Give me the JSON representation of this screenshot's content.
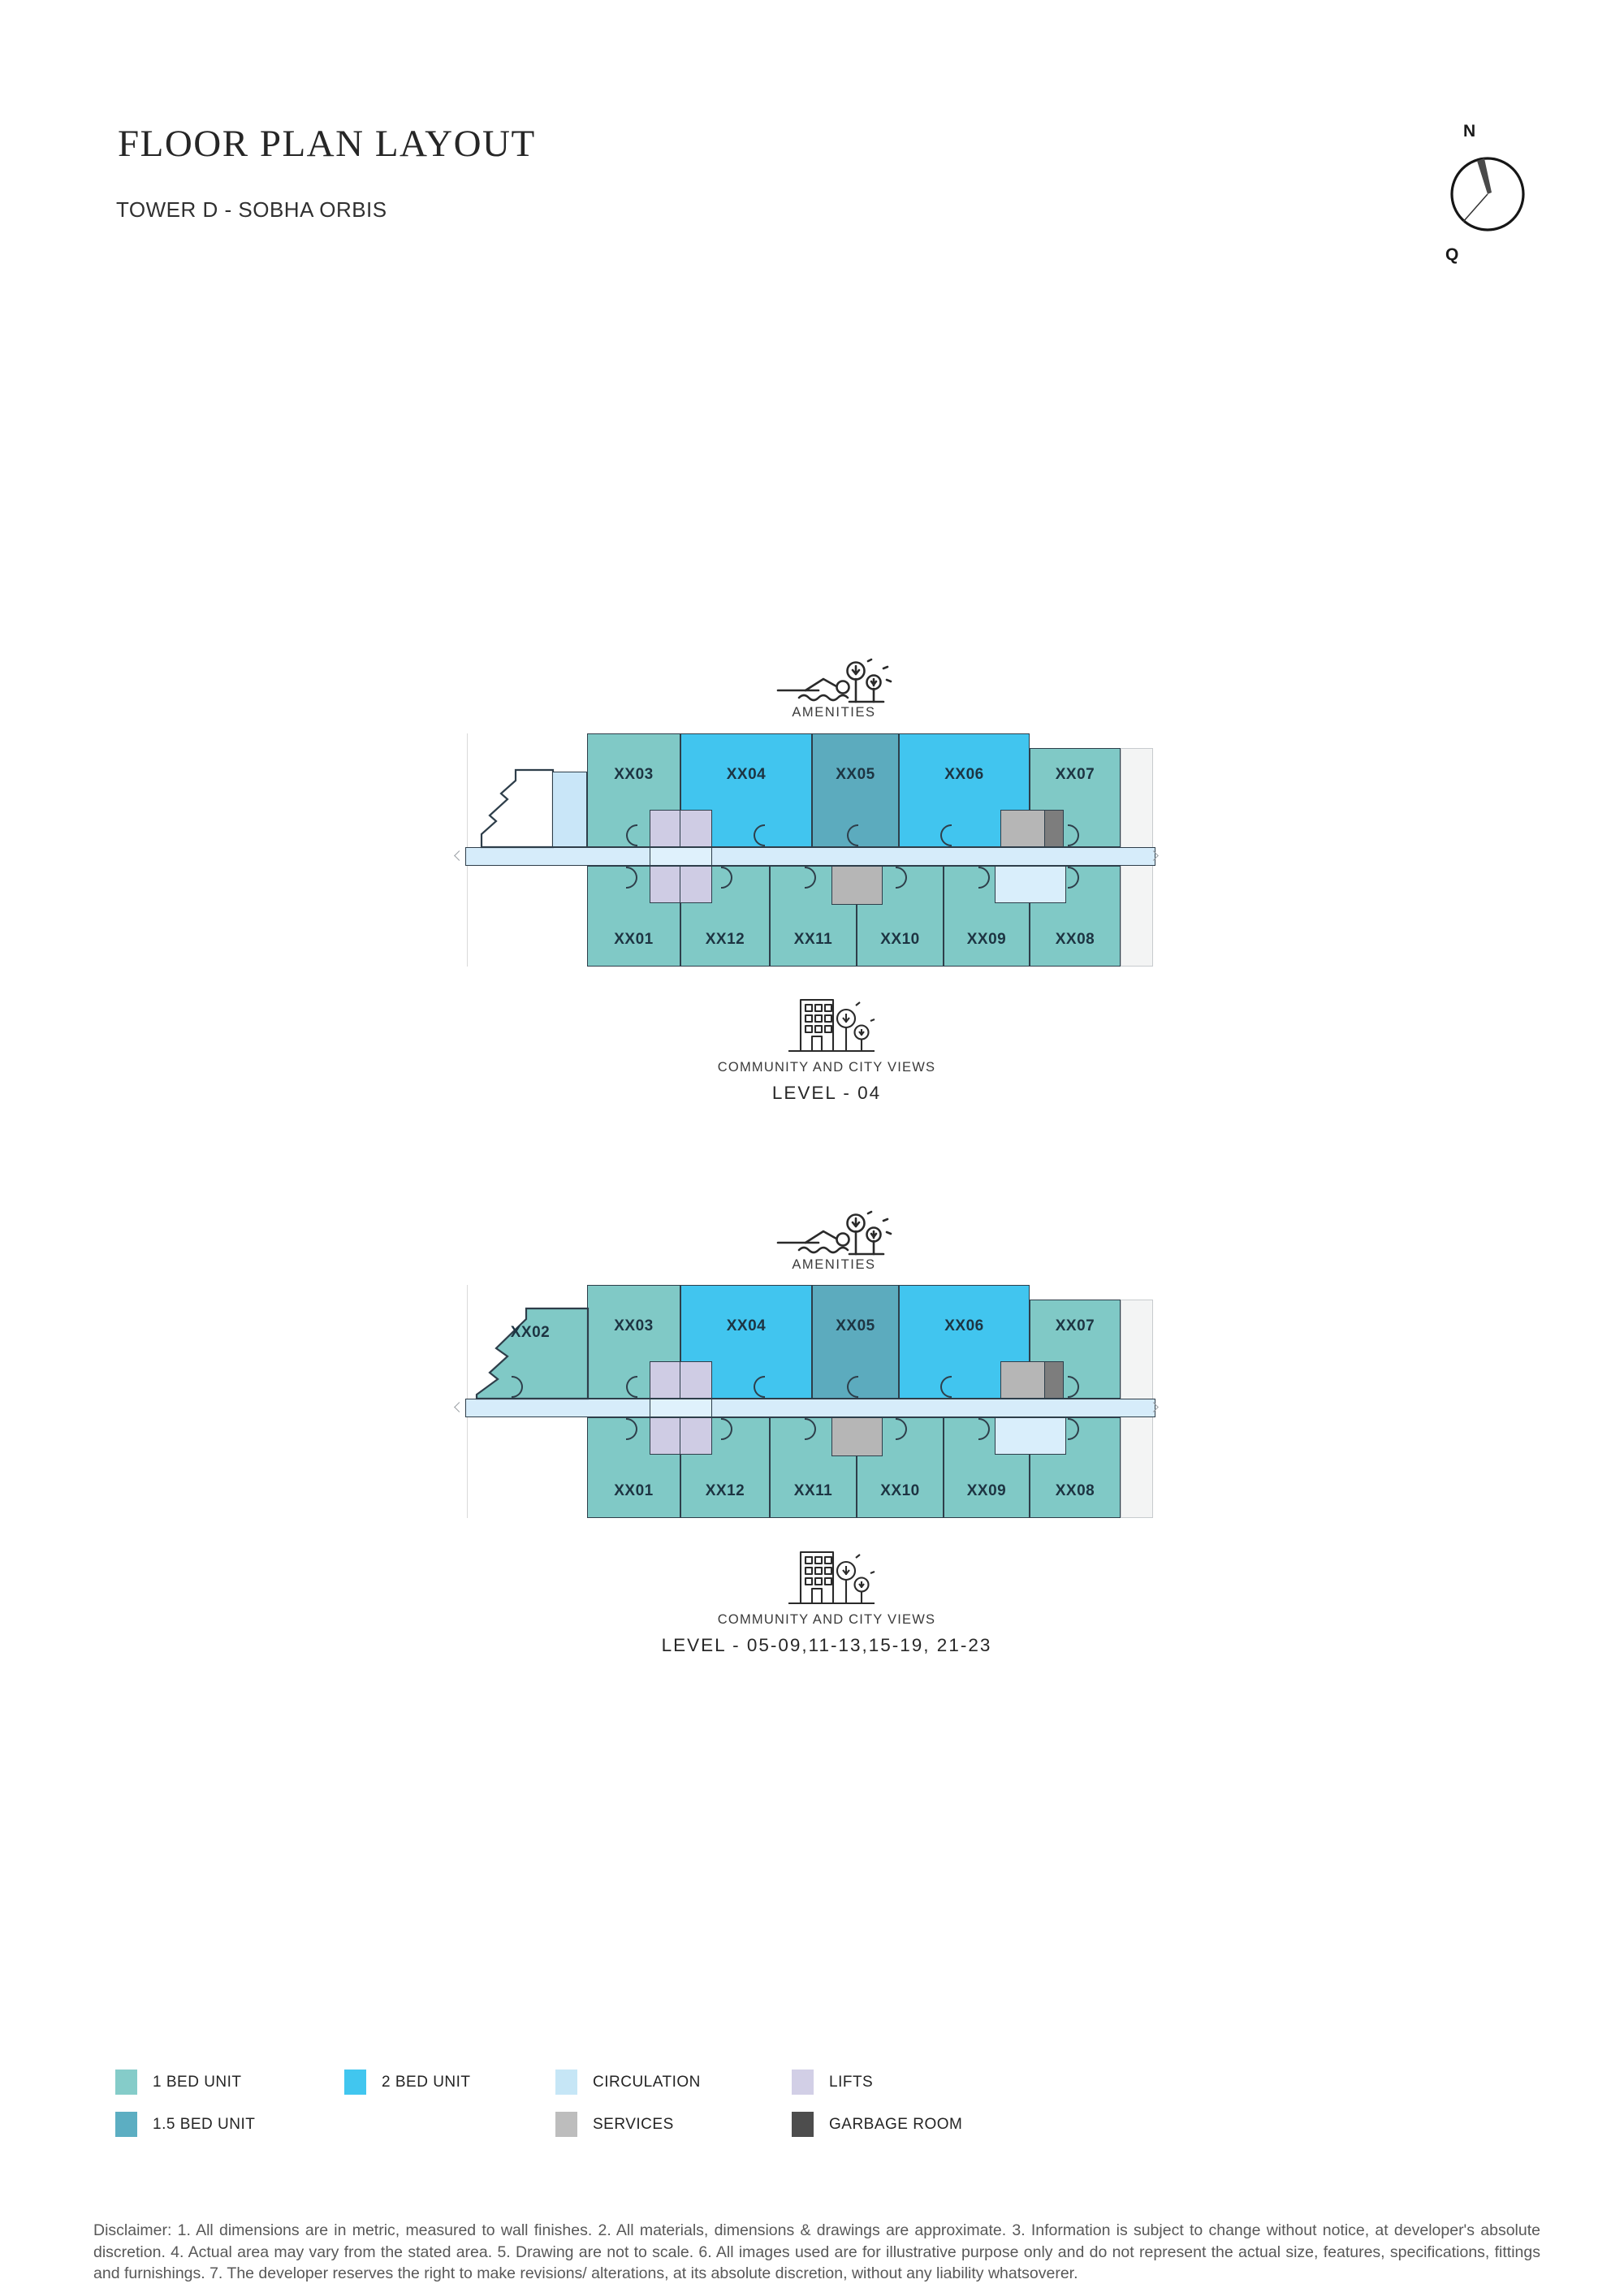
{
  "header": {
    "title": "FLOOR PLAN LAYOUT",
    "subtitle": "TOWER D - SOBHA ORBIS"
  },
  "compass": {
    "north_label": "N",
    "secondary_label": "Q"
  },
  "plans": [
    {
      "amenities_label": "AMENITIES",
      "views_label": "COMMUNITY AND CITY VIEWS",
      "level_label": "LEVEL - 04",
      "top_units": [
        {
          "id": "XX03",
          "type": "one_bed"
        },
        {
          "id": "XX04",
          "type": "two_bed"
        },
        {
          "id": "XX05",
          "type": "one_half_bed"
        },
        {
          "id": "XX06",
          "type": "two_bed"
        },
        {
          "id": "XX07",
          "type": "one_bed"
        }
      ],
      "bottom_units": [
        {
          "id": "XX01",
          "type": "one_bed"
        },
        {
          "id": "XX12",
          "type": "one_bed"
        },
        {
          "id": "XX11",
          "type": "one_bed"
        },
        {
          "id": "XX10",
          "type": "one_bed"
        },
        {
          "id": "XX09",
          "type": "one_bed"
        },
        {
          "id": "XX08",
          "type": "one_bed"
        }
      ],
      "corner_unit": null
    },
    {
      "amenities_label": "AMENITIES",
      "views_label": "COMMUNITY AND CITY VIEWS",
      "level_label": "LEVEL - 05-09,11-13,15-19, 21-23",
      "top_units": [
        {
          "id": "XX03",
          "type": "one_bed"
        },
        {
          "id": "XX04",
          "type": "two_bed"
        },
        {
          "id": "XX05",
          "type": "one_half_bed"
        },
        {
          "id": "XX06",
          "type": "two_bed"
        },
        {
          "id": "XX07",
          "type": "one_bed"
        }
      ],
      "bottom_units": [
        {
          "id": "XX01",
          "type": "one_bed"
        },
        {
          "id": "XX12",
          "type": "one_bed"
        },
        {
          "id": "XX11",
          "type": "one_bed"
        },
        {
          "id": "XX10",
          "type": "one_bed"
        },
        {
          "id": "XX09",
          "type": "one_bed"
        },
        {
          "id": "XX08",
          "type": "one_bed"
        }
      ],
      "corner_unit": {
        "id": "XX02",
        "type": "one_bed"
      }
    }
  ],
  "colors": {
    "one_bed": "#80C9C6",
    "two_bed": "#41C5EF",
    "one_half_bed": "#5CABBE",
    "corridor": "#D6ECFA",
    "circulation_block": "#C9E6F8",
    "lift_mid": "#DFF1FC",
    "lobby": "#D9EEFB",
    "lifts": "#CFCCE4",
    "services": "#B6B6B6",
    "garbage_plan": "#7D7D7D",
    "outline": "#2E3E4A"
  },
  "legend": {
    "items": [
      {
        "label": "1 BED UNIT",
        "color": "#85CCC9"
      },
      {
        "label": "2 BED UNIT",
        "color": "#41C6EF"
      },
      {
        "label": "CIRCULATION",
        "color": "#C6E6F6"
      },
      {
        "label": "LIFTS",
        "color": "#D2CFE6"
      },
      {
        "label": "1.5 BED UNIT",
        "color": "#5CAEC2"
      },
      {
        "label": "SERVICES",
        "color": "#BDBDBD"
      },
      {
        "label": "GARBAGE ROOM",
        "color": "#4D4D4D"
      }
    ]
  },
  "disclaimer": "Disclaimer: 1. All dimensions are in metric, measured to wall finishes. 2. All materials, dimensions & drawings are approximate. 3. Information is subject to change without notice, at developer's absolute discretion. 4. Actual area may vary from the stated area. 5. Drawing are not to scale. 6. All images used are for illustrative purpose only and do not represent the actual size, features, specifications, fittings and furnishings. 7. The developer reserves the right to make revisions/ alterations, at its absolute discretion, without any liability whatsoverer."
}
